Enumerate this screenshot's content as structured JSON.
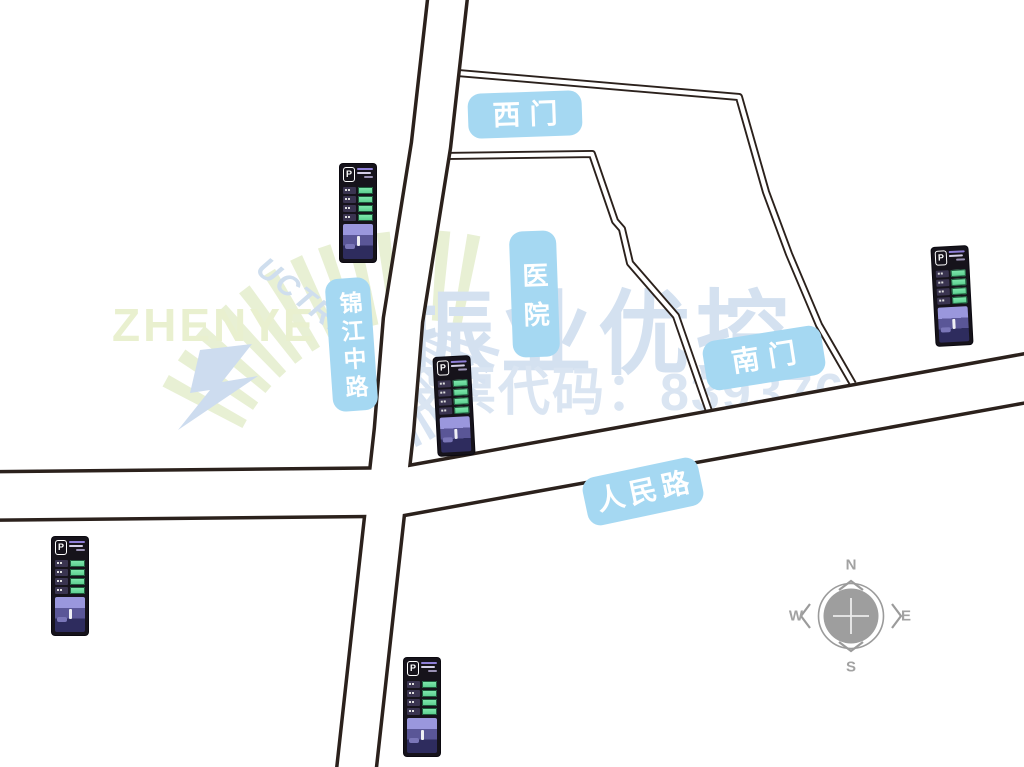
{
  "labels": {
    "west_gate": "西门",
    "hospital": "医院",
    "south_gate": "南门",
    "jinjiang_middle_road": "锦江中路",
    "renmin_road": "人民路"
  },
  "compass": {
    "north": "N",
    "south": "S",
    "east": "E",
    "west": "W"
  },
  "watermark": {
    "brand": "ZHENYE",
    "brand_overlay": "UCTRL",
    "company_name": "振业优控",
    "stock_code_label": "股票代码：839376"
  },
  "parking_sign": {
    "p_badge": "P"
  },
  "colors": {
    "road_casing": "#2b211c",
    "road_fill": "#ffffff",
    "label_background": "#a5d8f2",
    "label_text": "#ffffff",
    "compass_gray": "#9b9b9b",
    "sign_body": "#16131b",
    "sign_led_green": "#74e2a6",
    "watermark_blue": "#d4e1f0",
    "watermark_green": "#e8f0d4"
  }
}
